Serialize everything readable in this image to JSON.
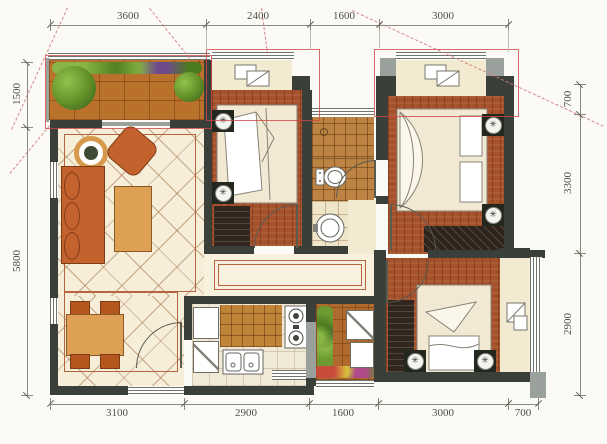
{
  "dimensions": {
    "top": [
      "3600",
      "2400",
      "1600",
      "3000"
    ],
    "bottom": [
      "3100",
      "2900",
      "1600",
      "3000",
      "700"
    ],
    "left": [
      "1500",
      "5800"
    ],
    "right": [
      "700",
      "3300",
      "2900"
    ]
  },
  "palette": {
    "wall": "#3a3f39",
    "wood_floor": "#a5512b",
    "balcony_deck": "#b9712c",
    "cream_floor": "#f3ead2",
    "living_tile": "#f6eed9",
    "corridor_tile": "#f8f1de",
    "border_line": "#b5643f",
    "highlight_red": "#cd4646",
    "dashed_pink": "#d68084",
    "furniture_orange": "#c4622e",
    "furniture_wood": "#dda055",
    "plant_green": "#618f28",
    "dim_text": "#4f4f45"
  },
  "icons": {
    "hvac": "✳"
  }
}
